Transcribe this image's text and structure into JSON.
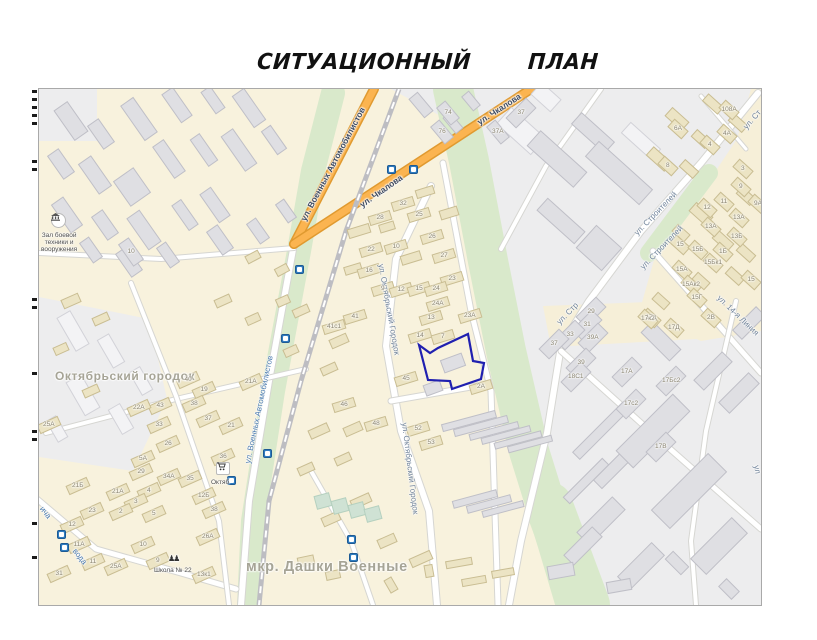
{
  "document": {
    "title": "СИТУАЦИОННЫЙ ПЛАН",
    "title_words": [
      "СИТУАЦИОННЫЙ",
      "ПЛАН"
    ]
  },
  "map": {
    "highlight_color": "#2020b0",
    "district_labels": [
      {
        "text": "Октябрьский городок",
        "x": 124,
        "y": 377,
        "size": 12
      },
      {
        "text": "мкр. Дашки Военные",
        "x": 326,
        "y": 567,
        "size": 14.5
      }
    ],
    "street_labels": [
      {
        "text": "ул. Военных Автомобилистов",
        "x": 331,
        "y": 163,
        "rot": -62,
        "cls": "major"
      },
      {
        "text": "ул. Чкалова",
        "x": 380,
        "y": 190,
        "rot": -35,
        "cls": "major"
      },
      {
        "text": "ул. Чкалова",
        "x": 498,
        "y": 108,
        "rot": -33,
        "cls": "major"
      },
      {
        "text": "ул. Военных Автомобилистов",
        "x": 258,
        "y": 408,
        "rot": -78,
        "cls": "blue"
      },
      {
        "text": "ул. Октябрьский Городок",
        "x": 388,
        "y": 308,
        "rot": 80,
        "cls": "st"
      },
      {
        "text": "ул. Октябрьский Городок",
        "x": 409,
        "y": 467,
        "rot": 83,
        "cls": "st"
      },
      {
        "text": "ул. Строителей",
        "x": 654,
        "y": 212,
        "rot": -46,
        "cls": "st"
      },
      {
        "text": "ул. Строителей",
        "x": 660,
        "y": 246,
        "rot": -46,
        "cls": "st"
      },
      {
        "text": "ул. Стр",
        "x": 566,
        "y": 312,
        "rot": -46,
        "cls": "st"
      },
      {
        "text": "ул. Ст",
        "x": 751,
        "y": 118,
        "rot": -49,
        "cls": "st"
      },
      {
        "text": "ул. 14-я Линия",
        "x": 737,
        "y": 314,
        "rot": 44,
        "cls": "st"
      },
      {
        "text": "ича",
        "x": 44,
        "y": 511,
        "rot": 52,
        "cls": "blue"
      },
      {
        "text": "вода",
        "x": 79,
        "y": 555,
        "rot": 52,
        "cls": "blue"
      },
      {
        "text": "ул",
        "x": 756,
        "y": 468,
        "rot": 80,
        "cls": "st"
      }
    ],
    "poi": [
      {
        "type": "museum",
        "x": 57,
        "y": 222,
        "label_lines": [
          "Зал боевой",
          "техники и",
          "вооружения"
        ],
        "lx": 58,
        "ly": 241
      },
      {
        "type": "school",
        "x": 172,
        "y": 556,
        "label_lines": [
          "Школа № 22"
        ],
        "lx": 172,
        "ly": 569
      },
      {
        "type": "store",
        "x": 222,
        "y": 470,
        "label_lines": [
          "Октяб"
        ],
        "lx": 219,
        "ly": 481
      }
    ],
    "transit_stops": [
      [
        390,
        168
      ],
      [
        412,
        168
      ],
      [
        298,
        268
      ],
      [
        284,
        337
      ],
      [
        266,
        452
      ],
      [
        230,
        479
      ],
      [
        350,
        538
      ],
      [
        352,
        556
      ],
      [
        60,
        533
      ],
      [
        63,
        546
      ]
    ],
    "building_numbers": [
      [
        "10",
        130,
        250
      ],
      [
        "74",
        447,
        111
      ],
      [
        "76",
        441,
        130
      ],
      [
        "37А",
        497,
        130
      ],
      [
        "37",
        520,
        111
      ],
      [
        "32",
        402,
        202
      ],
      [
        "28",
        379,
        216
      ],
      [
        "25",
        418,
        213
      ],
      [
        "26",
        431,
        235
      ],
      [
        "10",
        395,
        245
      ],
      [
        "22",
        370,
        248
      ],
      [
        "27",
        443,
        254
      ],
      [
        "16",
        368,
        269
      ],
      [
        "23",
        451,
        277
      ],
      [
        "9",
        382,
        287
      ],
      [
        "12",
        400,
        288
      ],
      [
        "15",
        418,
        287
      ],
      [
        "24",
        435,
        287
      ],
      [
        "24А",
        437,
        302
      ],
      [
        "13",
        430,
        316
      ],
      [
        "23А",
        469,
        314
      ],
      [
        "41",
        354,
        315
      ],
      [
        "41с1",
        333,
        325
      ],
      [
        "14",
        419,
        334
      ],
      [
        "7",
        442,
        335
      ],
      [
        "45",
        405,
        377
      ],
      [
        "2А",
        480,
        385
      ],
      [
        "46",
        343,
        403
      ],
      [
        "48",
        375,
        422
      ],
      [
        "52",
        417,
        427
      ],
      [
        "53",
        430,
        441
      ],
      [
        "21А",
        250,
        380
      ],
      [
        "40",
        187,
        378
      ],
      [
        "19",
        203,
        388
      ],
      [
        "38",
        193,
        402
      ],
      [
        "43",
        159,
        404
      ],
      [
        "22А",
        138,
        406
      ],
      [
        "33",
        158,
        423
      ],
      [
        "37",
        207,
        417
      ],
      [
        "21",
        230,
        424
      ],
      [
        "25А",
        48,
        423
      ],
      [
        "26",
        167,
        442
      ],
      [
        "36",
        222,
        455
      ],
      [
        "5А",
        142,
        457
      ],
      [
        "34А",
        168,
        475
      ],
      [
        "35",
        189,
        477
      ],
      [
        "29",
        140,
        470
      ],
      [
        "21Б",
        77,
        484
      ],
      [
        "21А",
        117,
        490
      ],
      [
        "4",
        148,
        489
      ],
      [
        "12Б",
        203,
        494
      ],
      [
        "3",
        135,
        500
      ],
      [
        "23",
        91,
        509
      ],
      [
        "2",
        120,
        510
      ],
      [
        "38",
        213,
        508
      ],
      [
        "5",
        153,
        512
      ],
      [
        "12",
        71,
        523
      ],
      [
        "11А",
        78,
        543
      ],
      [
        "26А",
        207,
        535
      ],
      [
        "10",
        142,
        543
      ],
      [
        "11",
        92,
        560
      ],
      [
        "25А",
        115,
        565
      ],
      [
        "31",
        58,
        572
      ],
      [
        "9",
        157,
        559
      ],
      [
        "13к1",
        203,
        573
      ],
      [
        "108А",
        728,
        108
      ],
      [
        "6А",
        677,
        127
      ],
      [
        "4А",
        726,
        132
      ],
      [
        "4",
        709,
        143
      ],
      [
        "8",
        667,
        164
      ],
      [
        "3",
        742,
        167
      ],
      [
        "9",
        740,
        185
      ],
      [
        "9А",
        757,
        202
      ],
      [
        "11",
        723,
        200
      ],
      [
        "12",
        706,
        206
      ],
      [
        "13А",
        738,
        216
      ],
      [
        "13А",
        710,
        225
      ],
      [
        "13Б",
        736,
        235
      ],
      [
        "15",
        679,
        243
      ],
      [
        "15Б",
        697,
        248
      ],
      [
        "1Б",
        722,
        250
      ],
      [
        "15Бк1",
        712,
        261
      ],
      [
        "15А",
        681,
        268
      ],
      [
        "15Ак2",
        690,
        283
      ],
      [
        "15Г",
        696,
        296
      ],
      [
        "15",
        750,
        278
      ],
      [
        "17д",
        650,
        316
      ],
      [
        "17Д",
        673,
        326
      ],
      [
        "2В",
        710,
        316
      ],
      [
        "29",
        590,
        310
      ],
      [
        "31",
        586,
        323
      ],
      [
        "17к2",
        647,
        317
      ],
      [
        "33",
        569,
        333
      ],
      [
        "39А",
        592,
        336
      ],
      [
        "37",
        553,
        342
      ],
      [
        "39",
        580,
        361
      ],
      [
        "18С1",
        575,
        375
      ],
      [
        "17А",
        626,
        370
      ],
      [
        "17Бс2",
        670,
        379
      ],
      [
        "17с2",
        630,
        402
      ],
      [
        "17В",
        660,
        445
      ]
    ]
  }
}
